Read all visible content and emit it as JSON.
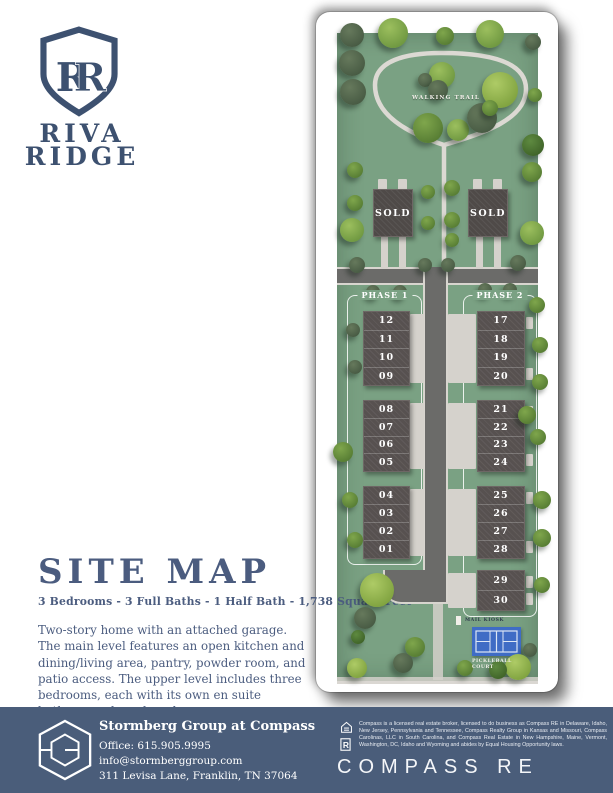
{
  "colors": {
    "brand_navy": "#3d5170",
    "heading_blue": "#4b5c7f",
    "footer_slate": "#4a5d7a",
    "grass_green": "#7aa183",
    "road_gray": "#6b6b69",
    "court_blue": "#3f6cc5",
    "card_white": "#ffffff"
  },
  "brand": {
    "monogram": "RR",
    "name_line1": "RIVA",
    "name_line2": "RIDGE"
  },
  "map": {
    "walking_trail_label": "WALKING TRAIL",
    "sold_label": "SOLD",
    "phase1": {
      "label": "PHASE 1",
      "blocks": [
        [
          "12",
          "11",
          "10",
          "09"
        ],
        [
          "08",
          "07",
          "06",
          "05"
        ],
        [
          "04",
          "03",
          "02",
          "01"
        ]
      ]
    },
    "phase2": {
      "label": "PHASE 2",
      "blocks": [
        [
          "17",
          "18",
          "19",
          "20"
        ],
        [
          "21",
          "22",
          "23",
          "24"
        ],
        [
          "25",
          "26",
          "27",
          "28"
        ],
        [
          "29",
          "30"
        ]
      ]
    },
    "mail_kiosk_label": "MAIL KIOSK",
    "pickleball_court_label": "PICKLEBALL\nCOURT"
  },
  "details": {
    "heading": "SITE MAP",
    "subheading": "3 Bedrooms - 3 Full Baths - 1 Half Bath - 1,738 Square Feet",
    "description": "Two-story home with an attached garage. The main level features an open kitchen and dining/living area, pantry, powder room, and patio access. The upper level includes three bedrooms, each with its own en suite bathroom, plus a laundry room."
  },
  "footer": {
    "team_name": "Stormberg Group at Compass",
    "office": "Office: 615.905.9995",
    "email": "info@stormberggroup.com",
    "address": "311 Levisa Lane, Franklin, TN 37064",
    "legal": "Compass is a licensed real estate broker, licensed to do business as Compass RE in Delaware, Idaho, New Jersey, Pennsylvania and Tennessee, Compass Realty Group in Kansas and Missouri, Compass Carolinas, LLC in South Carolina, and Compass Real Estate in New Hampshire, Maine, Vermont, Washington, DC, Idaho and Wyoming and abides by Equal Housing Opportunity laws.",
    "wordmark": "COMPASS RE",
    "icons": [
      "equal-housing-icon",
      "realtor-icon"
    ]
  }
}
